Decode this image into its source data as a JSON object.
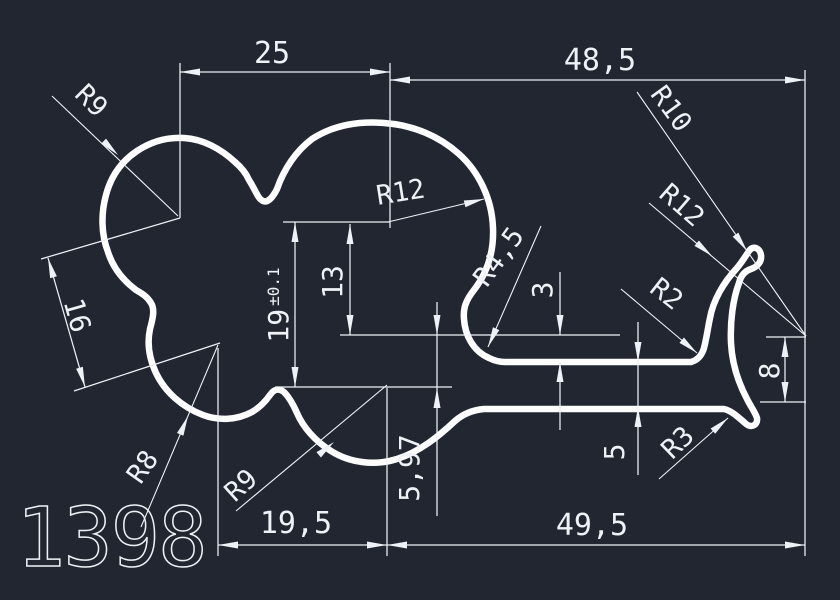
{
  "drawing": {
    "part_number": "1398",
    "colors": {
      "background": "#212630",
      "line": "#eef1f6",
      "profile": "#fdfdfe"
    },
    "dimensions": {
      "width_top_left": "25",
      "width_top_right": "48,5",
      "height_overall": "19",
      "height_overall_tol": "±0.1",
      "height_inner": "13",
      "offset_step": "3",
      "lobe_center_distance": "16",
      "lobe_drop": "5,97",
      "width_bottom_left": "19,5",
      "width_bottom_right": "49,5",
      "arm_thickness": "5",
      "hook_height": "8"
    },
    "radii": {
      "r9_top": "R9",
      "r12_main": "R12",
      "r10_hook": "R10",
      "r12_hook": "R12",
      "r4_5_neck": "R4,5",
      "r2_corner": "R2",
      "r8_lobe": "R8",
      "r9_lobe": "R9",
      "r3_tip": "R3"
    }
  }
}
